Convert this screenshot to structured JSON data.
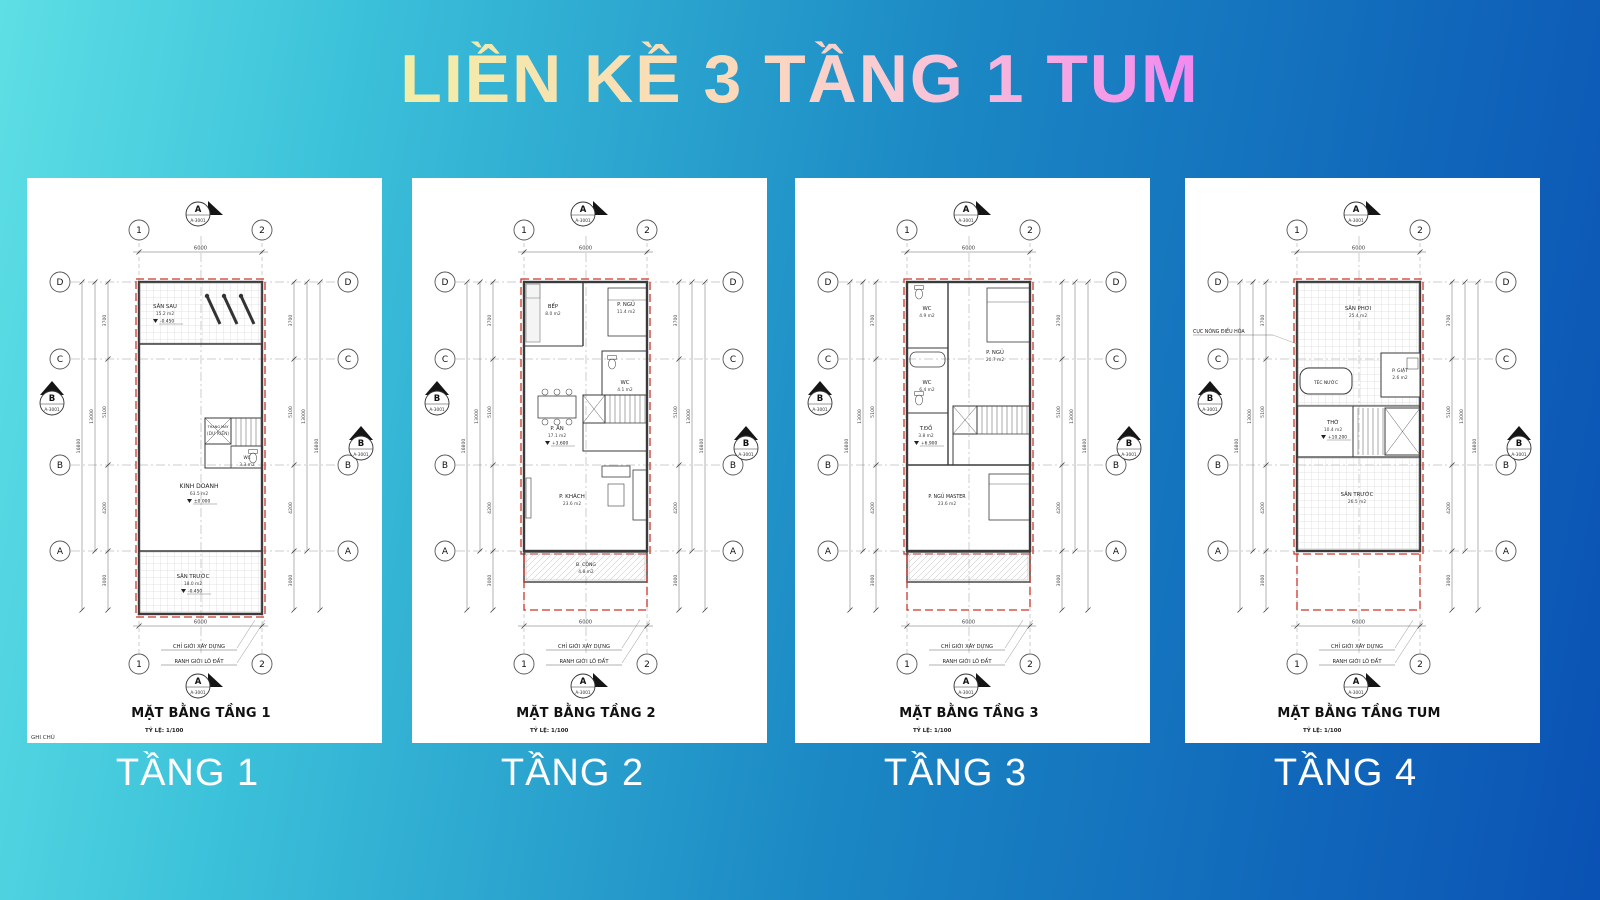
{
  "title": {
    "text": "LIỀN KỀ 3 TẦNG 1 TUM"
  },
  "colors": {
    "bg_start": "#5EDFE5",
    "bg_end": "#0A52B4",
    "title_gradient": [
      "#F3EDA6",
      "#FBD9BB",
      "#F9CBD4",
      "#F387F0"
    ],
    "plan_line": "#3A3A3A",
    "boundary_red": "#C9362B"
  },
  "plan_common": {
    "grid_columns": [
      "1",
      "2"
    ],
    "grid_rows": [
      "D",
      "C",
      "B",
      "A"
    ],
    "section_marker": {
      "top_letter": "A",
      "side_letter": "B",
      "sheet": "A-3001"
    },
    "dim_width": "6000",
    "dim_segments": [
      "3700",
      "5100",
      "4200",
      "3000"
    ],
    "dim_totals": [
      "13000",
      "16800"
    ],
    "boundary_label_1": "CHỈ GIỚI XÂY DỰNG",
    "boundary_label_2": "RANH GIỚI LÔ ĐẤT",
    "scale_label": "TỶ LỆ: 1/100"
  },
  "plans": [
    {
      "plan_title": "MẶT BẰNG TẦNG 1",
      "floor_label": "TẦNG 1",
      "note": "GHI CHÚ",
      "rooms": [
        {
          "label": "SÂN SAU",
          "sub": "15.2 m2",
          "elev": "-0.450"
        },
        {
          "label": "KINH DOANH",
          "sub": "63.5 m2",
          "elev": "±0.000"
        },
        {
          "label": "THANG MÁY",
          "sub": "(DỰ KIẾN)"
        },
        {
          "label": "WC",
          "sub": "3.3 m2"
        },
        {
          "label": "SÂN TRƯỚC",
          "sub": "18.0 m2",
          "elev": "-0.450"
        }
      ]
    },
    {
      "plan_title": "MẶT BẰNG TẦNG 2",
      "floor_label": "TẦNG 2",
      "rooms": [
        {
          "label": "BẾP",
          "sub": "8.0 m2"
        },
        {
          "label": "P. NGỦ",
          "sub": "11.4 m2"
        },
        {
          "label": "WC",
          "sub": "4.1 m2"
        },
        {
          "label": "P. ĂN",
          "sub": "17.1 m2",
          "elev": "+3.600"
        },
        {
          "label": "P. KHÁCH",
          "sub": "23.6 m2"
        },
        {
          "label": "B. CÔNG",
          "sub": "4.8 m2"
        }
      ]
    },
    {
      "plan_title": "MẶT BẰNG TẦNG 3",
      "floor_label": "TẦNG 3",
      "rooms": [
        {
          "label": "WC",
          "sub": "4.9 m2"
        },
        {
          "label": "P. NGỦ",
          "sub": "20.7 m2"
        },
        {
          "label": "WC",
          "sub": "6.4 m2"
        },
        {
          "label": "T.ĐỒ",
          "sub": "3.8 m2",
          "elev": "+6.900"
        },
        {
          "label": "P. NGỦ MASTER",
          "sub": "23.6 m2"
        }
      ]
    },
    {
      "plan_title": "MẶT BẰNG TẦNG TUM",
      "floor_label": "TẦNG 4",
      "side_label": "CỤC NÓNG ĐIỀU HÒA",
      "rooms": [
        {
          "label": "SÂN PHƠI",
          "sub": "25.4 m2"
        },
        {
          "label": "TÉC NƯỚC"
        },
        {
          "label": "P. GIẶT",
          "sub": "2.6 m2"
        },
        {
          "label": "THỜ",
          "sub": "10.4 m2",
          "elev": "+10.200"
        },
        {
          "label": "SÂN TRƯỚC",
          "sub": "26.5 m2"
        }
      ]
    }
  ]
}
